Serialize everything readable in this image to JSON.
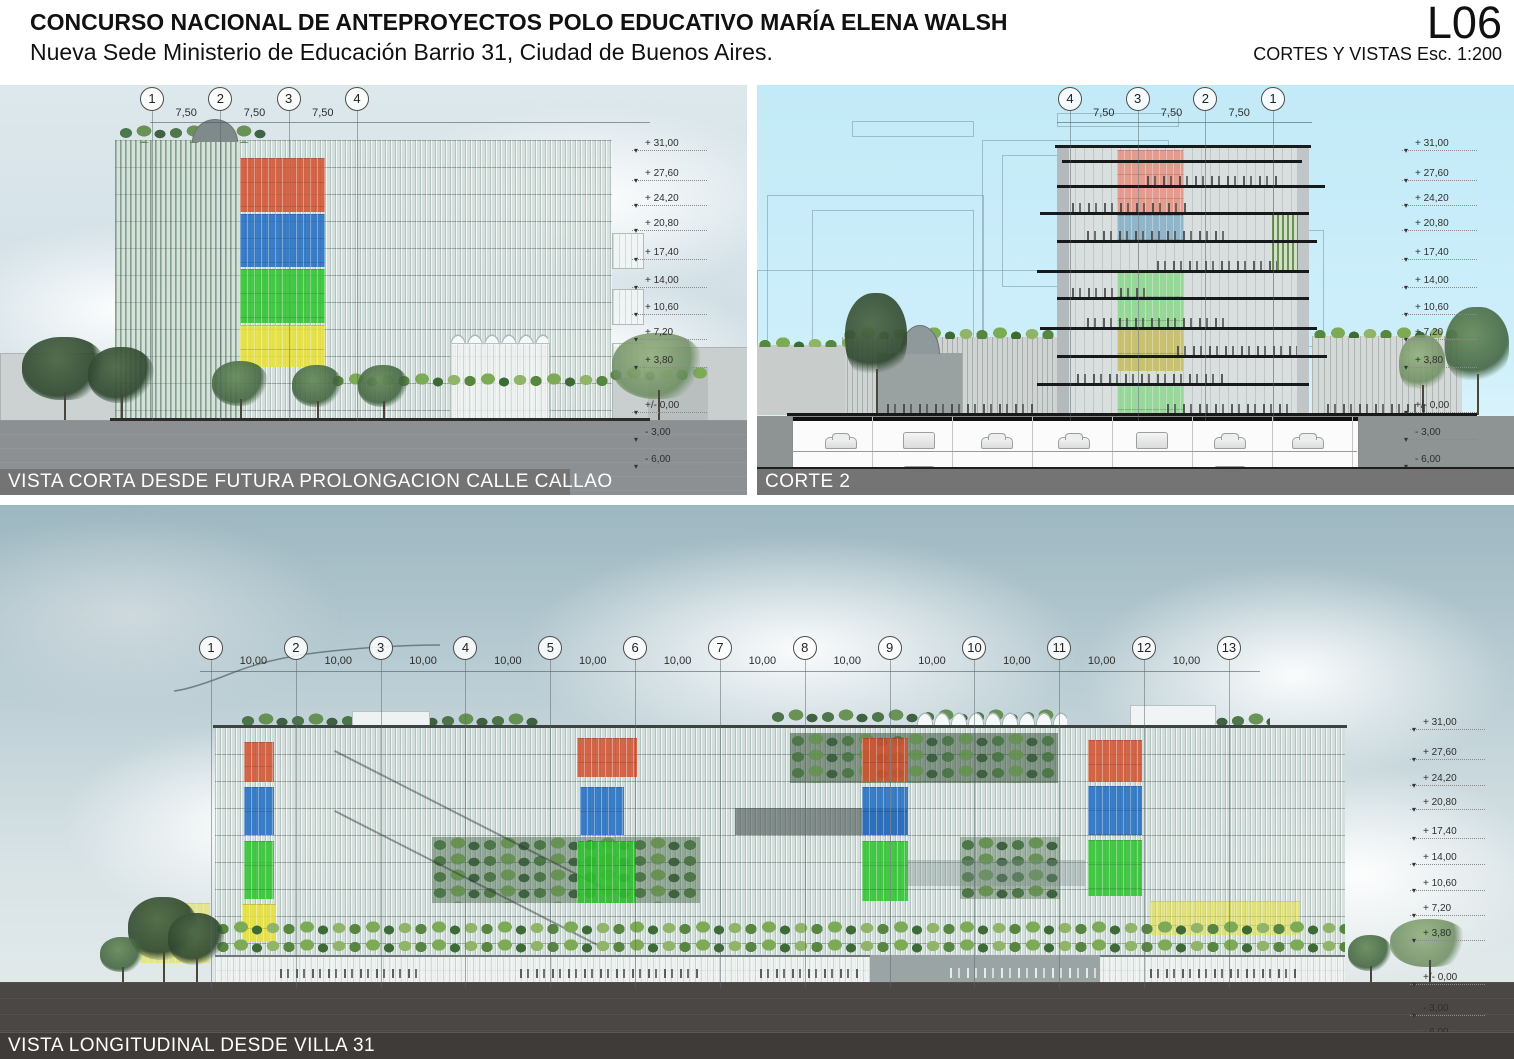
{
  "header": {
    "title": "CONCURSO NACIONAL DE ANTEPROYECTOS POLO EDUCATIVO MARÍA ELENA WALSH",
    "subtitle": "Nueva Sede Ministerio de Educación Barrio 31, Ciudad de Buenos Aires.",
    "sheet_code": "L06",
    "sheet_info": "CORTES Y VISTAS Esc. 1:200"
  },
  "panels": {
    "vista_corta": {
      "label": "VISTA CORTA DESDE FUTURA PROLONGACION CALLE CALLAO",
      "grid_bubbles": [
        "1",
        "2",
        "3",
        "4"
      ],
      "grid_dims": [
        "7,50",
        "7,50",
        "7,50"
      ],
      "levels": [
        "+ 31,00",
        "+ 27,60",
        "+ 24,20",
        "+ 20,80",
        "+ 17,40",
        "+ 14,00",
        "+ 10,60",
        "+ 7,20",
        "+ 3,80",
        "+/- 0,00",
        "- 3,00",
        "- 6,00"
      ]
    },
    "corte_2": {
      "label": "CORTE 2",
      "grid_bubbles": [
        "4",
        "3",
        "2",
        "1"
      ],
      "grid_dims": [
        "7,50",
        "7,50",
        "7,50"
      ],
      "levels": [
        "+ 31,00",
        "+ 27,60",
        "+ 24,20",
        "+ 20,80",
        "+ 17,40",
        "+ 14,00",
        "+ 10,60",
        "+ 7,20",
        "+ 3,80",
        "+/- 0,00",
        "- 3,00",
        "- 6,00"
      ]
    },
    "vista_longitudinal": {
      "label": "VISTA LONGITUDINAL DESDE VILLA 31",
      "grid_bubbles": [
        "1",
        "2",
        "3",
        "4",
        "5",
        "6",
        "7",
        "8",
        "9",
        "10",
        "11",
        "12",
        "13"
      ],
      "grid_dims": [
        "10,00",
        "10,00",
        "10,00",
        "10,00",
        "10,00",
        "10,00",
        "10,00",
        "10,00",
        "10,00",
        "10,00",
        "10,00",
        "10,00"
      ],
      "levels": [
        "+ 31,00",
        "+ 27,60",
        "+ 24,20",
        "+ 20,80",
        "+ 17,40",
        "+ 14,00",
        "+ 10,60",
        "+ 7,20",
        "+ 3,80",
        "+/- 0,00",
        "- 3,00",
        "- 6,00"
      ]
    }
  },
  "colors": {
    "facade_red": "#d2502e",
    "facade_blue": "#1f6cc2",
    "facade_green": "#2cc32c",
    "facade_yellow": "#e8e233",
    "section_salmon": "#e79181",
    "section_bluegray": "#85aec6",
    "section_green": "#8cd88c",
    "section_olive": "#c6bc5e",
    "section_green_base": "#8ed691",
    "ground_gray": "#8c9092",
    "ground_dark": "#4b4745",
    "label_bar": "#747474"
  }
}
